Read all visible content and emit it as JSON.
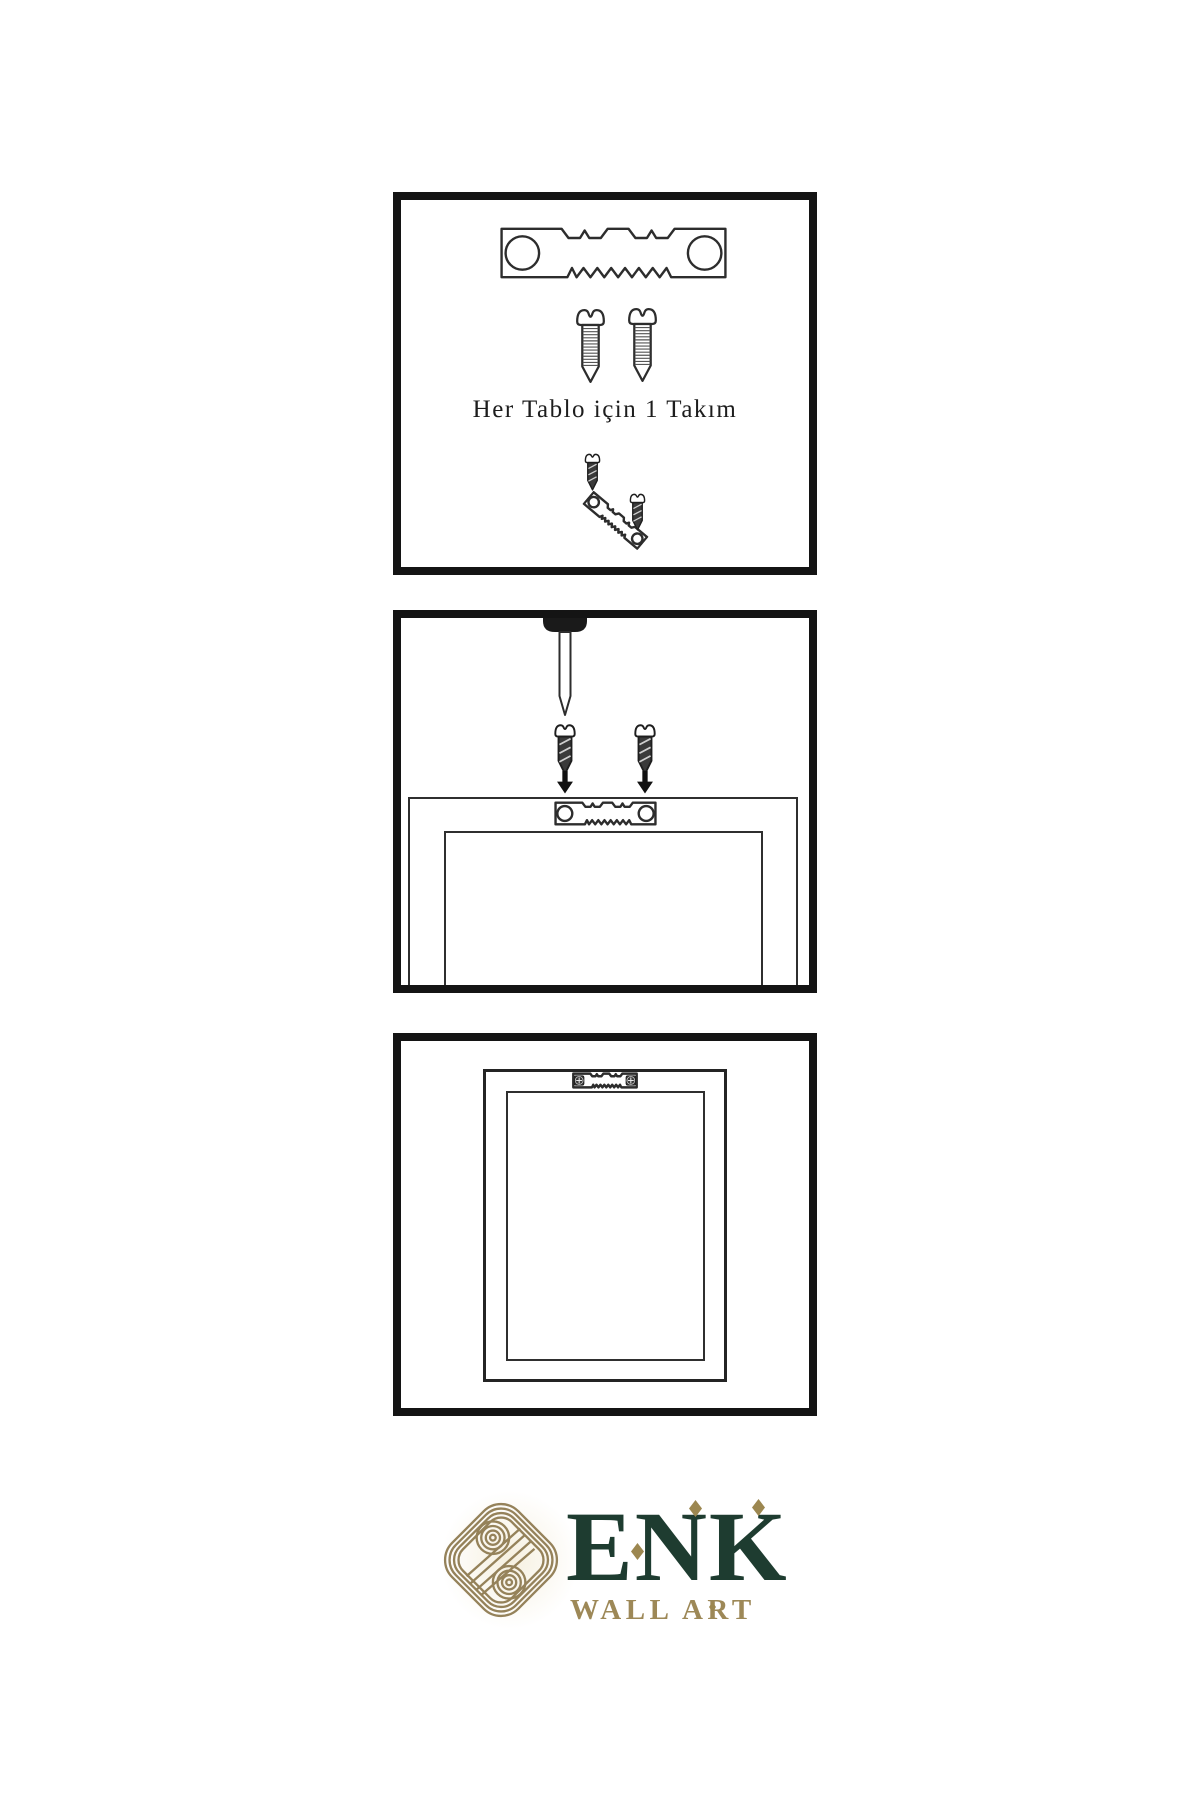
{
  "page": {
    "background": "#ffffff",
    "line_art_color": "#2d2d2d",
    "panel_border_color": "#141414"
  },
  "steps": [
    {
      "name": "kit-contents",
      "caption": "Her Tablo için 1 Takım",
      "items": [
        "sawtooth-hanger",
        "screw",
        "screw",
        "screw-dark",
        "tilted-sawtooth-hanger",
        "screw-dark"
      ]
    },
    {
      "name": "attach-hanger-to-frame",
      "items": [
        "wall-nail",
        "screw-dark",
        "screw-dark",
        "down-arrow",
        "down-arrow",
        "sawtooth-hanger",
        "frame-back"
      ]
    },
    {
      "name": "hang-frame-on-wall",
      "items": [
        "mounted-sawtooth-hanger",
        "frame-back"
      ]
    }
  ],
  "brand": {
    "wordmark": "ENK",
    "tagline": "WALL ART",
    "logo_icon": "knot-icon",
    "colors": {
      "green": "#1e3c30",
      "gold": "#97845a"
    }
  }
}
